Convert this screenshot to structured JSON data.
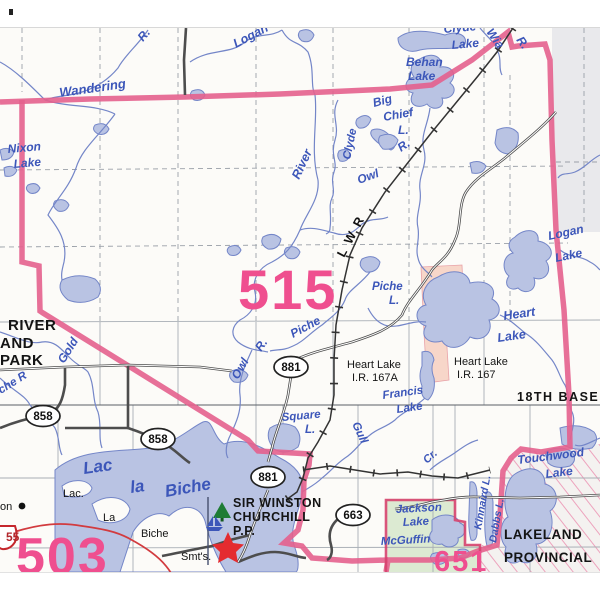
{
  "map": {
    "description": "Alberta provincial access map sheet, Lac la Biche / Heart Lake area",
    "colors": {
      "water_fill": "#b9c3e3",
      "water_stroke": "#7486c8",
      "water_text": "#3c56b9",
      "boundary_pink": "#e4608d",
      "region_number_pink": "#ef4f8f",
      "reserve_salmon": "#f7d6c9",
      "park_green": "#dcead2",
      "district_gray": "#e9e9ec",
      "road_dark": "#4d4d4d",
      "highway_red": "#d23b3f",
      "star_red": "#e42b30",
      "tree_green": "#1e7c35",
      "label_black": "#141414"
    },
    "region_numbers": [
      {
        "t": "515",
        "x": 238,
        "y": 309,
        "s": 56
      },
      {
        "t": "503",
        "x": 16,
        "y": 574,
        "s": 52
      },
      {
        "t": "651",
        "x": 434,
        "y": 571,
        "s": 29
      }
    ],
    "water_labels": [
      {
        "t": "Wandering",
        "x": 60,
        "y": 97,
        "r": -8,
        "s": 13
      },
      {
        "t": "R.",
        "x": 143,
        "y": 42,
        "r": -50,
        "s": 12
      },
      {
        "t": "Logan",
        "x": 236,
        "y": 48,
        "r": -28,
        "s": 12.5
      },
      {
        "t": "Behan",
        "x": 406,
        "y": 66,
        "r": 0,
        "s": 12
      },
      {
        "t": "Lake",
        "x": 408,
        "y": 80,
        "r": 0,
        "s": 12
      },
      {
        "t": "Big",
        "x": 374,
        "y": 107,
        "r": -15,
        "s": 12
      },
      {
        "t": "Chief",
        "x": 384,
        "y": 121,
        "r": -10,
        "s": 12
      },
      {
        "t": "L.",
        "x": 398,
        "y": 134,
        "r": 0,
        "s": 12
      },
      {
        "t": "R.",
        "x": 401,
        "y": 152,
        "r": -35,
        "s": 12
      },
      {
        "t": "Clyde",
        "x": 350,
        "y": 160,
        "r": -78,
        "s": 11.5
      },
      {
        "t": "River",
        "x": 299,
        "y": 180,
        "r": -65,
        "s": 12.5
      },
      {
        "t": "Owl",
        "x": 359,
        "y": 184,
        "r": -20,
        "s": 12
      },
      {
        "t": "Clyde",
        "x": 444,
        "y": 33,
        "r": -5,
        "s": 12
      },
      {
        "t": "Lake",
        "x": 452,
        "y": 49,
        "r": -5,
        "s": 12
      },
      {
        "t": "Wia",
        "x": 486,
        "y": 32,
        "r": 55,
        "s": 12
      },
      {
        "t": "R.",
        "x": 516,
        "y": 40,
        "r": 55,
        "s": 12
      },
      {
        "t": "Nixon",
        "x": 8,
        "y": 153,
        "r": -5,
        "s": 12
      },
      {
        "t": "Lake",
        "x": 14,
        "y": 168,
        "r": -5,
        "s": 12
      },
      {
        "t": "Logan",
        "x": 549,
        "y": 240,
        "r": -12,
        "s": 12
      },
      {
        "t": "Lake",
        "x": 556,
        "y": 262,
        "r": -12,
        "s": 12
      },
      {
        "t": "Piche",
        "x": 372,
        "y": 290,
        "r": 0,
        "s": 11.5
      },
      {
        "t": "L.",
        "x": 389,
        "y": 304,
        "r": 0,
        "s": 11.5
      },
      {
        "t": "Heart",
        "x": 504,
        "y": 320,
        "r": -8,
        "s": 12.5
      },
      {
        "t": "Lake",
        "x": 498,
        "y": 342,
        "r": -8,
        "s": 12.5
      },
      {
        "t": "Piche",
        "x": 293,
        "y": 338,
        "r": -28,
        "s": 12
      },
      {
        "t": "R.",
        "x": 261,
        "y": 352,
        "r": -55,
        "s": 12
      },
      {
        "t": "Owl",
        "x": 238,
        "y": 380,
        "r": -60,
        "s": 12
      },
      {
        "t": "Gold",
        "x": 64,
        "y": 364,
        "r": -58,
        "s": 12
      },
      {
        "t": "che R",
        "x": 1,
        "y": 394,
        "r": -32,
        "s": 11.5
      },
      {
        "t": "Square",
        "x": 282,
        "y": 421,
        "r": -5,
        "s": 11.5
      },
      {
        "t": "L.",
        "x": 305,
        "y": 433,
        "r": 0,
        "s": 11.5
      },
      {
        "t": "Francis",
        "x": 383,
        "y": 399,
        "r": -8,
        "s": 11.5
      },
      {
        "t": "Lake",
        "x": 397,
        "y": 413,
        "r": -8,
        "s": 11.5
      },
      {
        "t": "Gull",
        "x": 352,
        "y": 424,
        "r": 65,
        "s": 11.5
      },
      {
        "t": "Cr.",
        "x": 427,
        "y": 464,
        "r": -42,
        "s": 11
      },
      {
        "t": "Touchwood",
        "x": 518,
        "y": 464,
        "r": -7,
        "s": 12
      },
      {
        "t": "Lake",
        "x": 546,
        "y": 478,
        "r": -7,
        "s": 12
      },
      {
        "t": "Lac",
        "x": 84,
        "y": 474,
        "r": -8,
        "s": 17
      },
      {
        "t": "la",
        "x": 131,
        "y": 493,
        "r": -8,
        "s": 17
      },
      {
        "t": "Biche",
        "x": 166,
        "y": 497,
        "r": -10,
        "s": 17
      },
      {
        "t": "Jackson",
        "x": 396,
        "y": 513,
        "r": -3,
        "s": 11.5
      },
      {
        "t": "Lake",
        "x": 403,
        "y": 526,
        "r": -3,
        "s": 11.5
      },
      {
        "t": "McGuffin",
        "x": 381,
        "y": 545,
        "r": -3,
        "s": 11.5
      },
      {
        "t": "Kinnaird L.",
        "x": 481,
        "y": 530,
        "r": -80,
        "s": 10.5
      },
      {
        "t": "Dabbs L.",
        "x": 496,
        "y": 543,
        "r": -80,
        "s": 10.5
      }
    ],
    "place_labels": [
      {
        "t": "RIVER",
        "x": 8,
        "y": 330,
        "s": 15,
        "b": 1
      },
      {
        "t": "AND",
        "x": 0,
        "y": 348,
        "s": 15,
        "b": 1
      },
      {
        "t": "PARK",
        "x": 0,
        "y": 365,
        "s": 15,
        "b": 1
      },
      {
        "t": "Heart Lake",
        "x": 347,
        "y": 368,
        "s": 11,
        "b": 0
      },
      {
        "t": "I.R. 167A",
        "x": 352,
        "y": 381,
        "s": 11,
        "b": 0
      },
      {
        "t": "Heart Lake",
        "x": 454,
        "y": 365,
        "s": 11,
        "b": 0
      },
      {
        "t": "I.R. 167",
        "x": 457,
        "y": 378,
        "s": 11,
        "b": 0
      },
      {
        "t": "18TH BASE",
        "x": 517,
        "y": 401,
        "s": 12.5,
        "b": 1
      },
      {
        "t": "Lac.",
        "x": 63,
        "y": 497,
        "s": 11,
        "b": 0
      },
      {
        "t": "La",
        "x": 103,
        "y": 521,
        "s": 11,
        "b": 0
      },
      {
        "t": "Biche",
        "x": 141,
        "y": 537,
        "s": 11,
        "b": 0
      },
      {
        "t": "on",
        "x": 0,
        "y": 510,
        "s": 11,
        "b": 0
      },
      {
        "t": "Smt's.",
        "x": 181,
        "y": 560,
        "s": 11,
        "b": 0
      },
      {
        "t": "SIR WINSTON",
        "x": 233,
        "y": 507,
        "s": 12.5,
        "b": 1
      },
      {
        "t": "CHURCHILL",
        "x": 233,
        "y": 521,
        "s": 12.5,
        "b": 1
      },
      {
        "t": "P.P.",
        "x": 233,
        "y": 535,
        "s": 12.5,
        "b": 1
      },
      {
        "t": "LAKELAND",
        "x": 504,
        "y": 539,
        "s": 13.5,
        "b": 1
      },
      {
        "t": "PROVINCIAL",
        "x": 504,
        "y": 562,
        "s": 13.5,
        "b": 1
      }
    ],
    "road_shields": [
      {
        "t": "881",
        "x": 291,
        "y": 367
      },
      {
        "t": "881",
        "x": 268,
        "y": 477
      },
      {
        "t": "858",
        "x": 43,
        "y": 416
      },
      {
        "t": "858",
        "x": 158,
        "y": 439
      },
      {
        "t": "663",
        "x": 353,
        "y": 515
      }
    ],
    "highway_shield": {
      "t": "55",
      "x": 6,
      "y": 541
    },
    "railway_label": {
      "t": "L W R",
      "x": 344,
      "y": 258,
      "r": -62,
      "s": 12.5
    },
    "legend_semantics": {
      "pink_thick_line": "map sheet / municipal district boundary",
      "pink_numbers": "map sheet numbers",
      "salmon_area": "Indian Reserve (Heart Lake I.R.)",
      "green_area": "provincial park / recreation area",
      "hatched_area": "Lakeland Provincial area",
      "star": "point of interest at Sir Winston Churchill P.P.",
      "ovals": "secondary highway markers",
      "red_shield": "Highway 55 marker",
      "black_ticked_line": "railway (L W R)"
    }
  }
}
